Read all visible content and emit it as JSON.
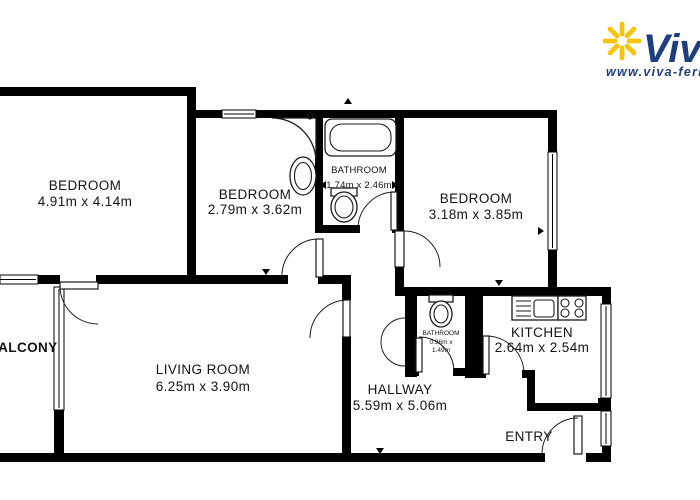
{
  "logo": {
    "brand": "Viva",
    "url": "www.viva-feri",
    "star_color": "#F5C40E",
    "text_color": "#1E3F7E"
  },
  "rooms": {
    "bedroom1": {
      "name": "BEDROOM",
      "dims": "4.91m x 4.14m"
    },
    "bedroom2": {
      "name": "BEDROOM",
      "dims": "2.79m x 3.62m"
    },
    "bathroom_main": {
      "name": "BATHROOM",
      "dims": "1.74m x 2.46m"
    },
    "bedroom3": {
      "name": "BEDROOM",
      "dims": "3.18m x 3.85m"
    },
    "living_room": {
      "name": "LIVING ROOM",
      "dims": "6.25m x 3.90m"
    },
    "hallway": {
      "name": "HALLWAY",
      "dims": "5.59m x 5.06m"
    },
    "bathroom_small": {
      "name": "BATHROOM",
      "dims_line1": "0.96m x",
      "dims_line2": "1.49m"
    },
    "kitchen": {
      "name": "KITCHEN",
      "dims": "2.64m x 2.54m"
    },
    "balcony": {
      "name": "BALCONY"
    },
    "entry": {
      "name": "ENTRY"
    }
  },
  "colors": {
    "wall": "#000000",
    "label": "#141414",
    "background": "#ffffff"
  }
}
